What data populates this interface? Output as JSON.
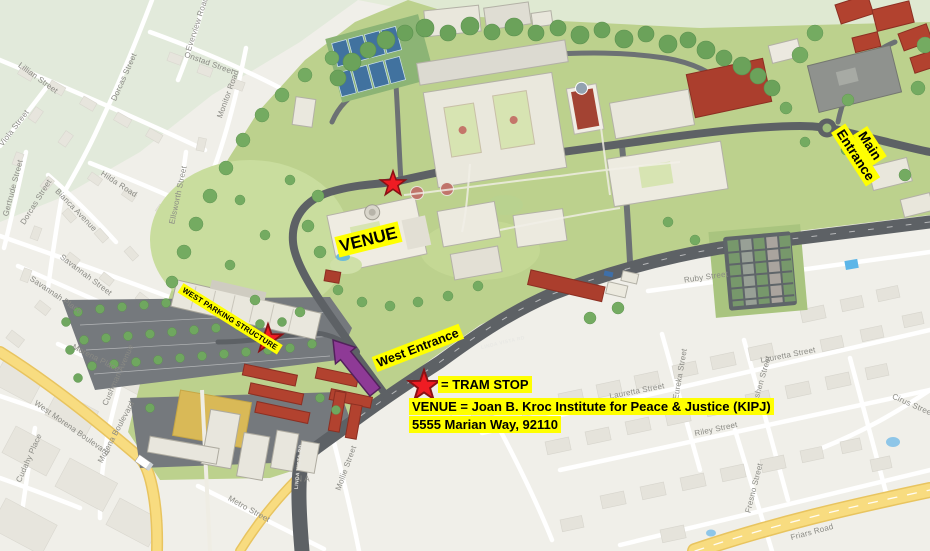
{
  "annotations": {
    "main_entrance": "Main Entrance",
    "venue_label": "VENUE",
    "west_parking": "WEST PARKING STRUCTURE",
    "west_entrance": "West Entrance",
    "tram_stop_legend": "= TRAM STOP",
    "venue_info_line1": "VENUE = Joan B. Kroc Institute for Peace & Justice (KIPJ)",
    "venue_info_line2": "5555 Marian Way, 92110"
  },
  "road_labels": [
    "LINDA VISTA RD",
    "LINDA VISTA RD"
  ],
  "streets": [
    "Lillian Street",
    "Dorcas Street",
    "Everview Road",
    "Onstad Street",
    "Monitor Road",
    "Viola Street",
    "Gertrude Street",
    "Dorcas Street",
    "Bianca Avenue",
    "Hilda Road",
    "Ellsworth Street",
    "Savannah Street",
    "Savannah Place",
    "Morena Place",
    "Cushman Avenue",
    "Morena Boulevard",
    "West Morena Boulevard",
    "Cudahy Place",
    "Metro Street",
    "Mollie Street",
    "Ruby Street",
    "Lauretta Street",
    "Lauretta Street",
    "Eureka Street",
    "Goshen Street",
    "Riley Street",
    "Fresno Street",
    "Friars Road",
    "Cirus Street",
    "N A"
  ],
  "markers": {
    "tram_stop_count": 3,
    "star_color": "#ee1c23",
    "star_outline": "#8a1114",
    "arrow_color": "#8e3a96",
    "highlight_color": "#ffff00",
    "campus_green": "#bcd18d",
    "road_gray": "#5d6165",
    "map_background": "#f0efe9",
    "highway_yellow": "#f6d87b"
  }
}
